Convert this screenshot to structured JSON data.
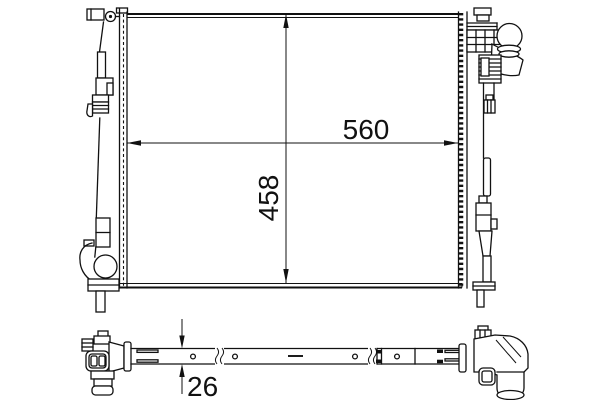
{
  "drawing": {
    "colors": {
      "background": "#ffffff",
      "line": "#111111"
    },
    "dimensions": {
      "width": {
        "label": "560",
        "orientation": "horizontal"
      },
      "height": {
        "label": "458",
        "orientation": "vertical"
      },
      "thickness": {
        "label": "26",
        "orientation": "vertical"
      }
    }
  }
}
